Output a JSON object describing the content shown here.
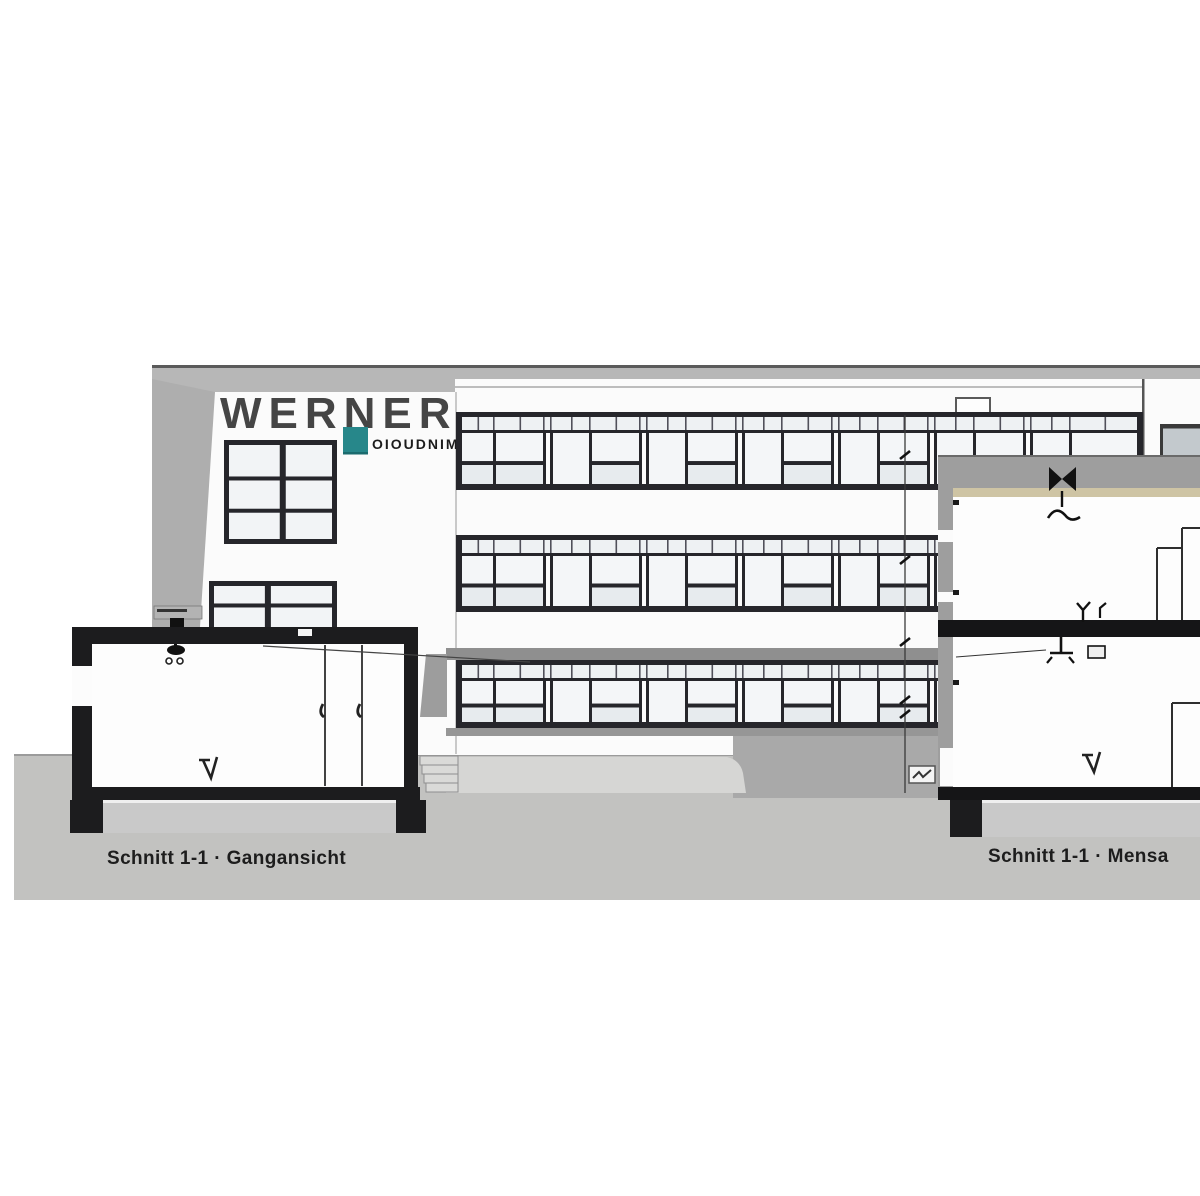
{
  "signage": {
    "company_name": "WERNER",
    "tagline": "OIOUDNIMA"
  },
  "captions": {
    "left": "Schnitt 1-1 · Gangansicht",
    "right": "Schnitt 1-1 · Mensa"
  },
  "colors": {
    "accent_teal": "#27878a",
    "ground_gray": "#c2c2c0",
    "window_frame": "#26262b",
    "slab_black": "#151517",
    "ceiling_tan": "#cec4a4",
    "wall_gray": "#9e9e9e"
  }
}
